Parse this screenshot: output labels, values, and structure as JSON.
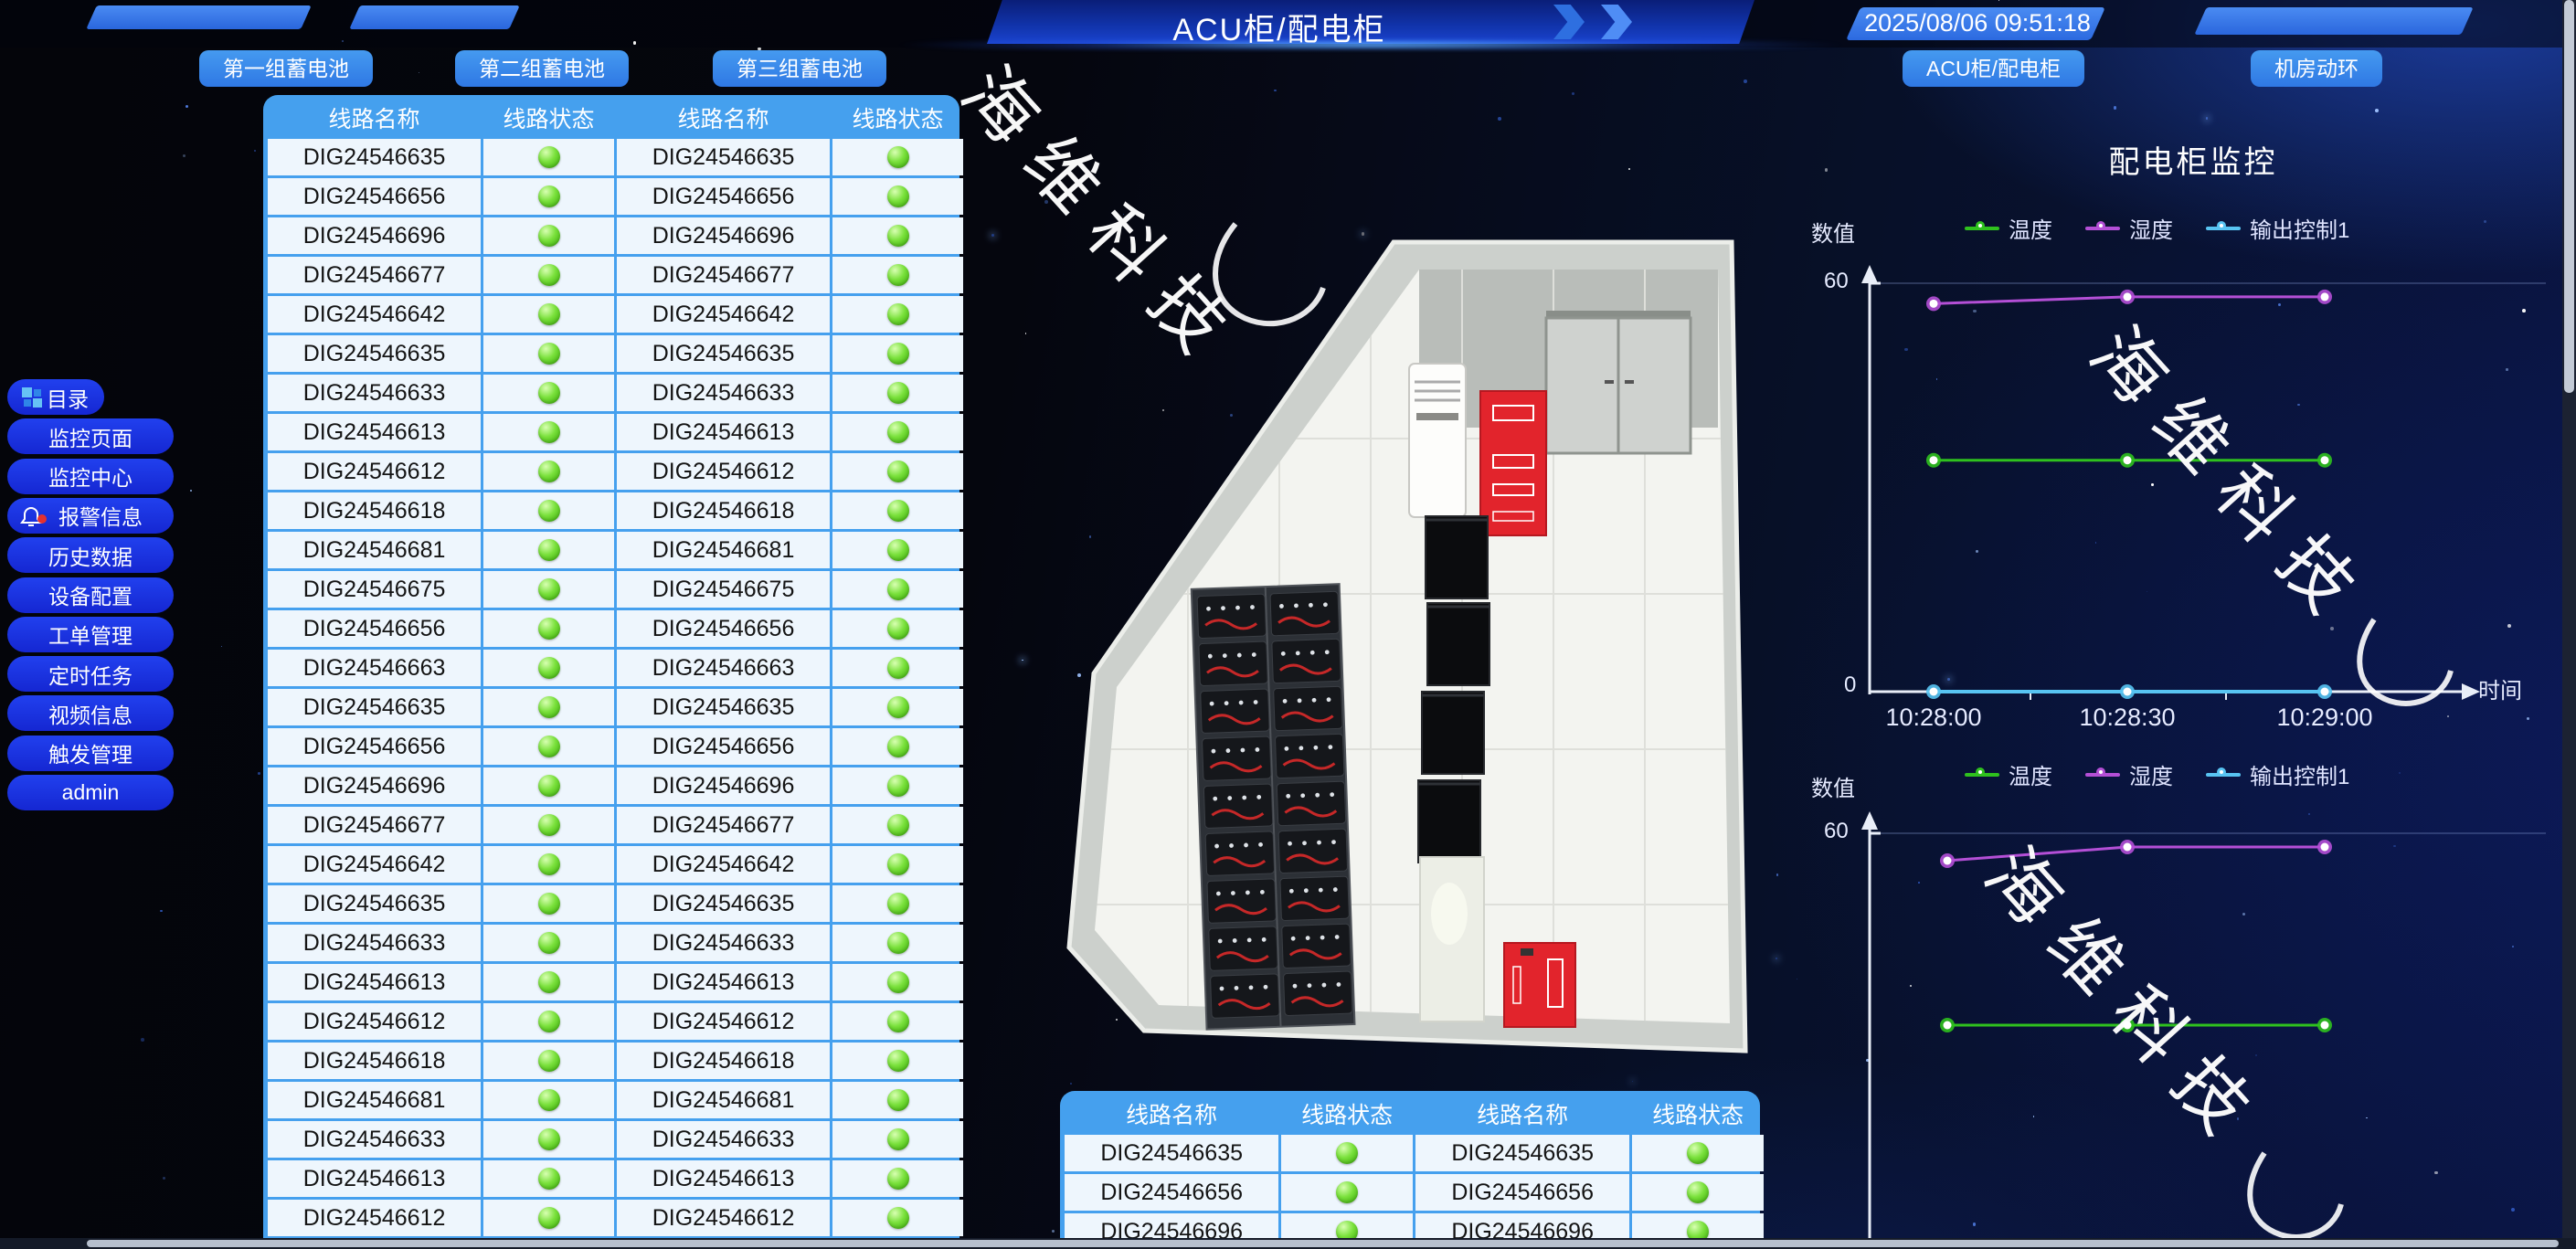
{
  "header": {
    "title": "ACU柜/配电柜",
    "timestamp": "2025/08/06 09:51:18",
    "battery_buttons": [
      "第一组蓄电池",
      "第二组蓄电池",
      "第三组蓄电池"
    ],
    "right_buttons": [
      "ACU柜/配电柜",
      "机房动环"
    ]
  },
  "sidebar": {
    "items": [
      {
        "label": "目录",
        "icon": "grid-icon"
      },
      {
        "label": "监控页面"
      },
      {
        "label": "监控中心"
      },
      {
        "label": "报警信息",
        "icon": "bell-alert-icon"
      },
      {
        "label": "历史数据"
      },
      {
        "label": "设备配置"
      },
      {
        "label": "工单管理"
      },
      {
        "label": "定时任务"
      },
      {
        "label": "视频信息"
      },
      {
        "label": "触发管理"
      },
      {
        "label": "admin"
      }
    ]
  },
  "line_table": {
    "headers": [
      "线路名称",
      "线路状态",
      "线路名称",
      "线路状态"
    ],
    "status": "green",
    "rows": [
      "DIG24546635",
      "DIG24546656",
      "DIG24546696",
      "DIG24546677",
      "DIG24546642",
      "DIG24546635",
      "DIG24546633",
      "DIG24546613",
      "DIG24546612",
      "DIG24546618",
      "DIG24546681",
      "DIG24546675",
      "DIG24546656",
      "DIG24546663",
      "DIG24546635",
      "DIG24546656",
      "DIG24546696",
      "DIG24546677",
      "DIG24546642",
      "DIG24546635",
      "DIG24546633",
      "DIG24546613",
      "DIG24546612",
      "DIG24546618",
      "DIG24546681",
      "DIG24546633",
      "DIG24546613",
      "DIG24546612"
    ]
  },
  "bottom_table": {
    "headers": [
      "线路名称",
      "线路状态",
      "线路名称",
      "线路状态"
    ],
    "status": "green",
    "rows": [
      "DIG24546635",
      "DIG24546656",
      "DIG24546696"
    ]
  },
  "watermark": {
    "text": "海维科技"
  },
  "chart_data": [
    {
      "type": "line",
      "title": "配电柜监控",
      "ylabel": "数值",
      "xlabel": "时间",
      "ylim": [
        0,
        60
      ],
      "yticks": [
        "0",
        "60"
      ],
      "x": [
        "10:28:00",
        "10:28:30",
        "10:29:00"
      ],
      "legend_position": "top",
      "series": [
        {
          "name": "温度",
          "color": "#2fc11e",
          "values": [
            34,
            34,
            34
          ]
        },
        {
          "name": "湿度",
          "color": "#b44fd6",
          "values": [
            57,
            58,
            58
          ]
        },
        {
          "name": "输出控制1",
          "color": "#58c4f2",
          "values": [
            0,
            0,
            0
          ]
        }
      ]
    },
    {
      "type": "line",
      "title": "",
      "ylabel": "数值",
      "xlabel": "",
      "ylim": [
        0,
        60
      ],
      "yticks": [
        "60"
      ],
      "x": [
        "10:28:00",
        "10:28:30",
        "10:29:00"
      ],
      "legend_position": "top",
      "series": [
        {
          "name": "温度",
          "color": "#2fc11e",
          "values": [
            32,
            32,
            32
          ]
        },
        {
          "name": "湿度",
          "color": "#b44fd6",
          "values": [
            56,
            58,
            58
          ]
        },
        {
          "name": "输出控制1",
          "color": "#58c4f2",
          "values": []
        }
      ]
    }
  ]
}
